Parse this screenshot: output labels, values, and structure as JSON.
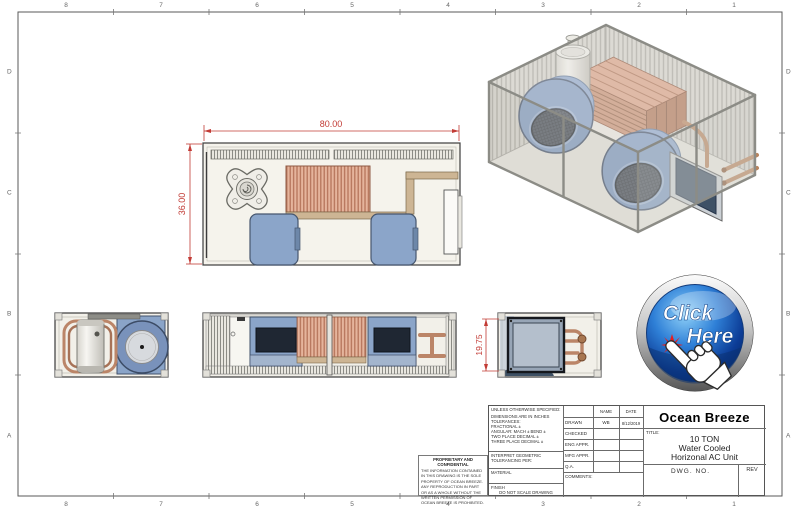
{
  "drawing": {
    "zones_top": [
      "8",
      "7",
      "6",
      "5",
      "4",
      "3",
      "2",
      "1"
    ],
    "zones_bottom": [
      "8",
      "7",
      "6",
      "5",
      "4",
      "3",
      "2",
      "1"
    ],
    "zones_left": [
      "D",
      "C",
      "B",
      "A"
    ],
    "zones_right": [
      "D",
      "C",
      "B",
      "A"
    ]
  },
  "dimensions": {
    "plan_width": "80.00",
    "plan_depth": "36.00",
    "end_height": "19.75"
  },
  "click_button": {
    "line1": "Click",
    "line2": "Here"
  },
  "title_block": {
    "company": "Ocean Breeze",
    "title_label": "TITLE:",
    "title_lines": [
      "10 TON",
      "Water Cooled",
      "Horizonal AC Unit"
    ],
    "dwg_no_label": "DWG.  NO.",
    "rev_label": "REV",
    "spec": {
      "header": "UNLESS OTHERWISE SPECIFIED:",
      "lines": [
        "DIMENSIONS ARE IN INCHES",
        "TOLERANCES:",
        "FRACTIONAL ±",
        "ANGULAR: MACH ±   BEND ±",
        "TWO PLACE DECIMAL    ±",
        "THREE PLACE DECIMAL  ±"
      ],
      "interpret_line1": "INTERPRET GEOMETRIC",
      "interpret_line2": "TOLERANCING PER:",
      "material_label": "MATERIAL",
      "finish_label": "FINISH",
      "do_not_scale": "DO NOT SCALE DRAWING"
    },
    "approvals": {
      "name_header": "NAME",
      "date_header": "DATE",
      "rows": [
        {
          "label": "DRAWN",
          "name": "WB",
          "date": "8/12/2019"
        },
        {
          "label": "CHECKED",
          "name": "",
          "date": ""
        },
        {
          "label": "ENG APPR.",
          "name": "",
          "date": ""
        },
        {
          "label": "MFG APPR.",
          "name": "",
          "date": ""
        },
        {
          "label": "Q.A.",
          "name": "",
          "date": ""
        }
      ],
      "comments_label": "COMMENTS:"
    },
    "proprietary": {
      "header": "PROPRIETARY AND CONFIDENTIAL",
      "body": "THE INFORMATION CONTAINED IN THIS DRAWING IS THE SOLE PROPERTY OF OCEAN BREEZE.  ANY REPRODUCTION IN PART OR AS A WHOLE WITHOUT THE WRITTEN PERMISSION OF OCEAN BREEZE IS PROHIBITED."
    }
  },
  "colors": {
    "dimension_red": "#c23b35",
    "blower_blue": "#8aa5c9",
    "coil_copper": "#cf9277",
    "pipe_tan": "#cdb594",
    "button_blue": "#1c55b0",
    "starburst_red": "#e81c1c"
  }
}
